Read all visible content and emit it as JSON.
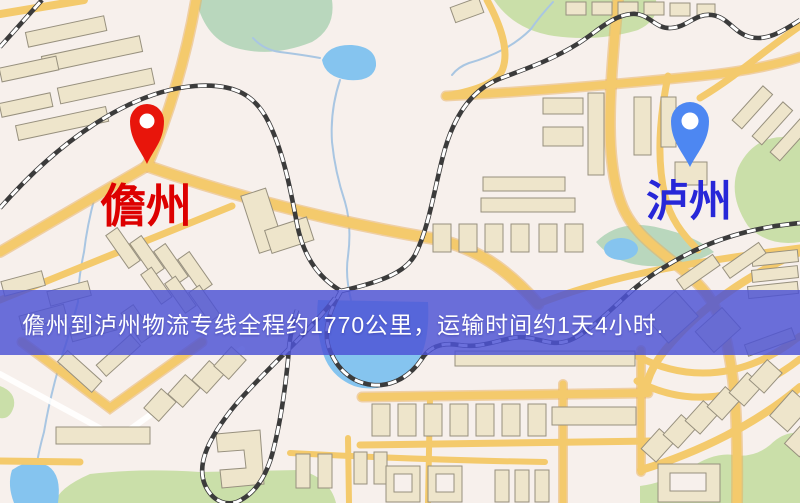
{
  "map": {
    "origin_marker": {
      "label": "儋州"
    },
    "destination_marker": {
      "label": "泸州"
    },
    "banner": {
      "text": "儋州到泸州物流专线全程约1770公里，运输时间约1天4小时."
    }
  },
  "icons": {
    "origin_pin": "location-pin",
    "destination_pin": "location-pin"
  },
  "palette": {
    "background": "#f7f0ec",
    "road": "#f4ca6c",
    "roadCasing": "#e7ad5c",
    "minorRoad": "#ffffff",
    "building": "#eee5cb",
    "buildingOutline": "#97907e",
    "park": "#cadfa9",
    "parkTeal": "#b9d7bd",
    "water": "#85c4ef",
    "creek": "#a9c6e2",
    "railDark": "#3b3b3b",
    "railLight": "#ffffff",
    "bannerBg": "rgba(77,83,213,0.83)",
    "bannerText": "#ffffff",
    "pinRed": "#e8150b",
    "pinBlue": "#4d87f2",
    "originText": "#dd0000",
    "destText": "#2727d8"
  }
}
